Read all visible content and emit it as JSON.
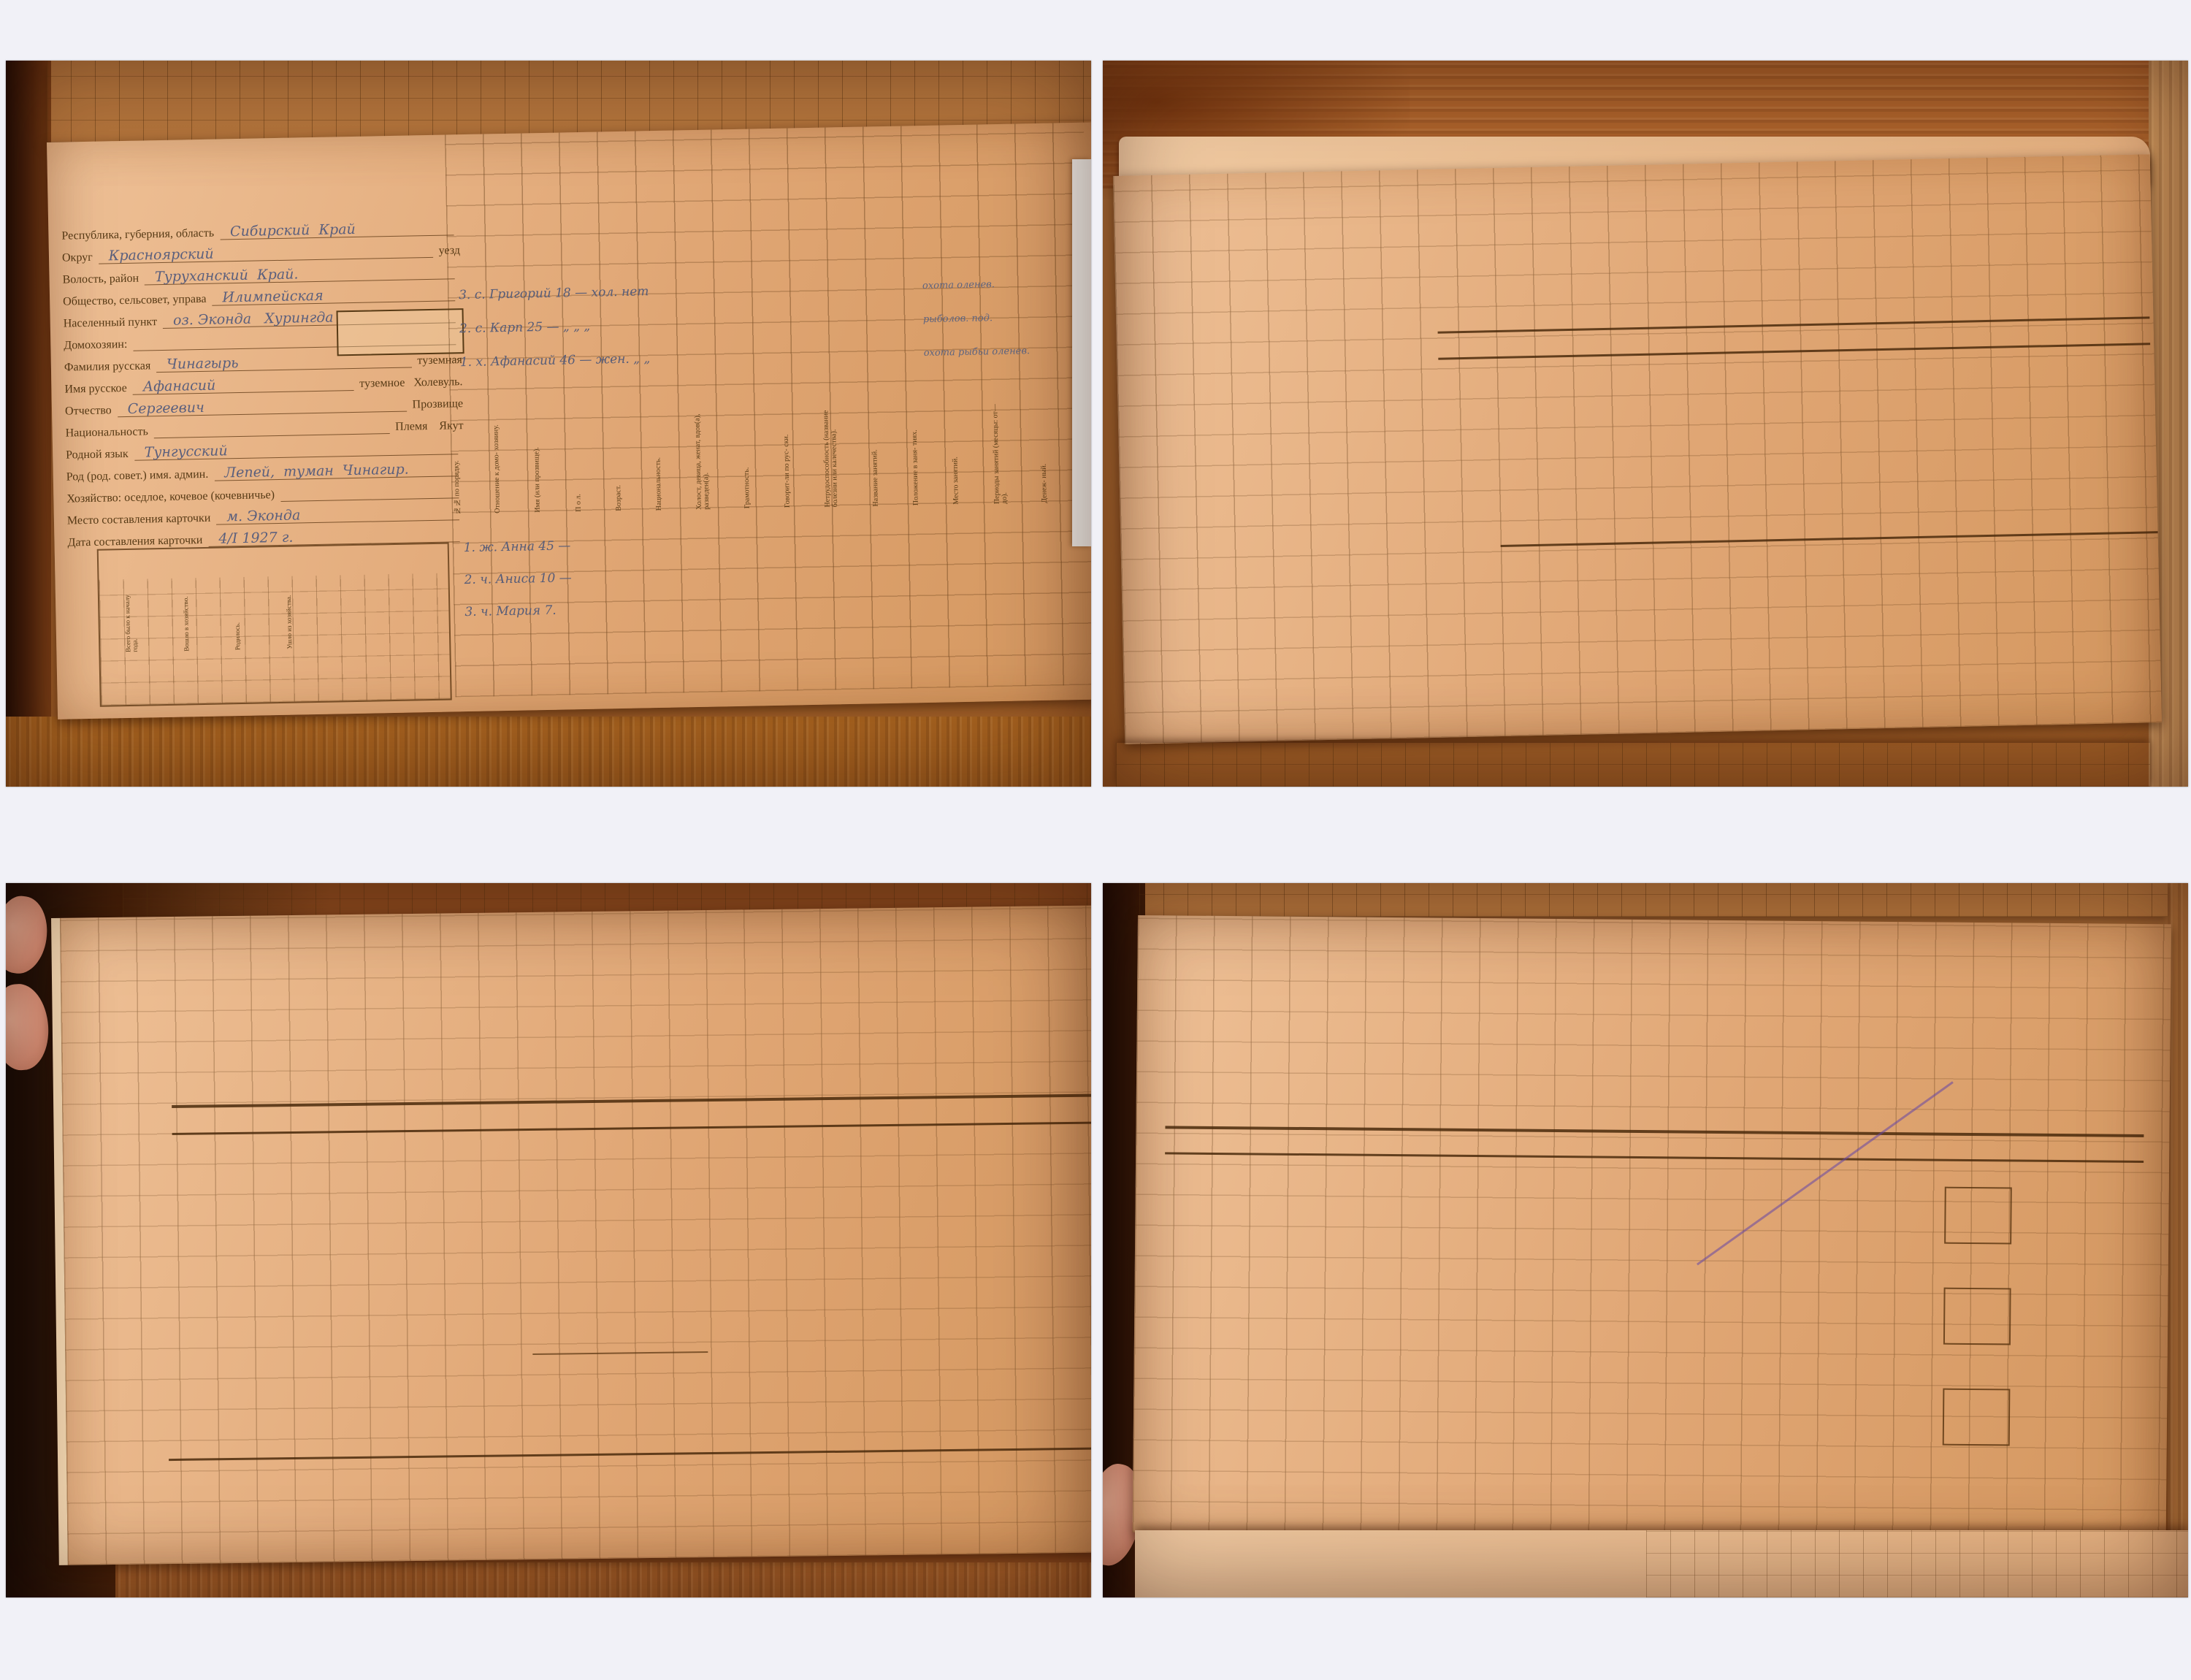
{
  "page": {
    "title": "ГАКК ф.Р769 оп.1 дело 406 21/71"
  },
  "caption": {
    "line1": "23-251,3(РК):007 - оз. Хурунгда - Чинагырь Афанасий Сергеевич [Холевуль]",
    "enumerator": "Enumerator: Наумов Н. П.",
    "date": "1927:01:04",
    "ethnicity": "Якуты",
    "ids": {
      "p1": "GAKK_769-1-406_041",
      "p2": "GAKK_769-1-406_041v",
      "p3": "GAKK_769-1-406_042",
      "p4": "GAKK_769-1-406_042v"
    }
  },
  "p1": {
    "roll": {
      "gosorganam": "Госор- ганам.",
      "vsego": "ВСЕГО.",
      "dobyto": "Добыто за год.",
      "hw": "180  104"
    },
    "ussr": "С.  С.  С.  Р.",
    "csu": "Ц.  С.  У.",
    "census": "Перепись 1926 - 27 года в районах приполярного Севера.",
    "card_title": "ПОХОЗЯЙСТВЕННАЯ  КАРТОЧКА.",
    "fields": [
      {
        "label": "Республика, губерния, область",
        "value": "Сибирский  Край",
        "extra": ""
      },
      {
        "label": "Округ",
        "value": "Красноярский",
        "extra": "уезд"
      },
      {
        "label": "Волость, район",
        "value": "Туруханский  Край.",
        "extra": ""
      },
      {
        "label": "Общество, сельсовет, управа",
        "value": "Илимпейская",
        "extra": ""
      },
      {
        "label": "Населенный пункт",
        "value": "оз. Эконда   Хурингда",
        "extra": ""
      },
      {
        "label": "Домохозяин:",
        "value": "",
        "extra": ""
      },
      {
        "label": "Фамилия русская",
        "value": "Чинагырь",
        "extra": "туземная"
      },
      {
        "label": "Имя русское",
        "value": "Афанасий",
        "extra": "туземное   Холевуль."
      },
      {
        "label": "Отчество",
        "value": "Сергеевич",
        "extra": "Прозвище"
      },
      {
        "label": "Национальность",
        "value": "",
        "extra": "Племя    Якут"
      },
      {
        "label": "Родной язык",
        "value": "Тунгусский",
        "extra": ""
      },
      {
        "label": "Род (род. совет.) имя. админ.",
        "value": "Лепей,  туман  Чинагир.",
        "extra": ""
      },
      {
        "label": "Хозяйство: оседлое, кочевое (кочевничье)",
        "value": "",
        "extra": ""
      },
      {
        "label": "Место составления карточки",
        "value": "м. Эконда",
        "extra": ""
      },
      {
        "label": "Дата составления карточки",
        "value": "4/I 1927 г.",
        "extra": ""
      }
    ],
    "num_box": {
      "no": "№",
      "struck": "13.",
      "value": "7.",
      "list": "по списку домохозяев."
    },
    "movement": {
      "title": "Движение населения в хозяйстве.",
      "cols": [
        "Всего было к началу года.",
        "Вошло в хозяйство.",
        "Родилось.",
        "Ушло из хозяйства."
      ],
      "died": "У М Е Р Л О.",
      "men": "Мужчин.",
      "women": "Женщин.",
      "years": "Годы.",
      "numbers": "40   41   42   43   44   45   46   47   48   49   50   51   52",
      "hw": "3     3",
      "hw2": "3     3"
    },
    "red_mark": "И 23",
    "table": {
      "itogo": "Итого.",
      "hw_itogo": "3.",
      "hw_top": "3",
      "members": [
        "3.    с.    Григорий    18     —    хол.   нет",
        "2.    с.    Карп         25     —    „      „      „",
        "1.    х.    Афанасий   46     —    жен.   „      „"
      ],
      "occupations": [
        "охота  оленев.",
        "рыболов.   под.",
        "охота  рыбьи  оленев."
      ],
      "numbers1": "1    2    3    4   5   6    7   8   9    10    11    12    13    14    15   16   17   18   19   20",
      "headers": [
        "№№ по порядку.",
        "Отношение к домо- хозяину.",
        "Имя (или прозвище).",
        "П о л.",
        "Возраст.",
        "Национальность.",
        "Холост, девица, женат, вдов(а), разведен(а).",
        "Грамотность.",
        "Говорит-ли по рус- ски.",
        "Нетрудоспособность (название болезни или калечества).",
        "Название занятий.",
        "Положение в заня- тиях.",
        "Место занятий.",
        "Периоды занятий (месяцы: от—до).",
        "Денеж- ный.",
        "Натурой (в переводе на деньги)."
      ],
      "numbers2": "21    22    23    24   25   26    27   28   29    30    31    32    33    34    35   36   37   38   39",
      "members_f": [
        "1.    ж.    Анна      45    —",
        "2.    ч.    Аниса    10    —",
        "3.    ч.    Мария    7."
      ]
    },
    "bookmark": "муравьиные яйца, АВГ"
  },
  "p2": {
    "head_cells": [
      "В наличии своего.",
      "Отдано своего на выпас на сторону.",
      "Принято чужого на выпас."
    ],
    "categories": "КАТЕГОРИИ СКОТА.",
    "numbers1": "53  54  55  56  57  58  59  60  61  62  63  64  65  66  67  68  69  70  71  72  73  74  75  76  77  78",
    "cat_labels": [
      "Старше 4 лет.",
      "До 4 лет.",
      "Рабочие.",
      "Гулевые старше 4 лет.",
      "От 1 г. до раб. возраста.",
      "Жеребята до 1 года.",
      "Итого голов.",
      "Волы.",
      "Рабочие.",
      "Производит.",
      "Коровы.",
      "Бычки от 1 до 2 лет.",
      "Нетели и телята.",
      "От 6 мес. до 1 года.",
      "До 6 мес.",
      "Итого голов.",
      "Взрослые.",
      "Ягнята.",
      "Итого голов."
    ],
    "groups": {
      "horses": "Л О Ш А Д И.",
      "cattle": "КРУПНЫЙ  РОГАТЫЙ  СКОТ.",
      "sheep": "О В Ц Ы.",
      "goats": "К О З Ы.",
      "pigs": "СВИНЬИ.",
      "total": "ВСЕГО голов скота."
    },
    "band": "С К О Т ,     К Р О М Е     О Л Е Н Е Й",
    "band_sub": "(число голов).",
    "hire_note": "Наем годовых и сроковых рабочих в течение года.",
    "hire_band": "ПОДЕННЫЙ  И  СДЕЛЬНЫЙ  НАЕМ  РАБОЧИХ.",
    "hire_labels": [
      "Для каких работ нанят (указательно).",
      "Национальность.",
      "Из какого рода.",
      "П о л.",
      "Возраст.",
      "Грамотность.",
      "Местный или пришлый.",
      "Срок найма.",
      "Деньгами.",
      "Натурой в пе- рев. на деньги.",
      "Чья харчи.",
      "Отрасли хозяй- ства, в которых производится работа по найму.",
      "Взросл. рабоч. Муж- чин.",
      "Жен- щин.",
      "Деньгами.",
      "Натурой (в пе- реводе на день- ги)."
    ],
    "numbers2": "111  112  113  114  115 116 117 118 119 120      121      122   123   124   125   126   127      128    129    130    131    132",
    "rows": [
      "Оленеводство.",
      "Рыболовство."
    ],
    "right_rows": [
      "Рыболовство.",
      "Охота  .  .  .",
      "И т о г о.  ."
    ],
    "guns": {
      "vband": "Огнестрельные.",
      "band": "Р У Ж Ь Я.",
      "rows": [
        "Одно- ствол.",
        "Дву- ствол.",
        "Одно- ствол.",
        "Дву- ствол.",
        "Кремне- вые."
      ],
      "extra": [
        "Пистолеты и револьверы.",
        "Луки."
      ]
    },
    "left_numbers": "133 134 135 136 137 138 139 140 141 142 143 144 145",
    "deer": {
      "band": "О Л Е Н И",
      "band_sub": "(число голов по дню переписи).",
      "categories": "КАТЕГОРИИ ОЛЕНЕЙ.",
      "adults": "Взрослые (старше двух лет).",
      "young": "Молодняк",
      "total": "ВСЕГО оленей",
      "cols": [
        "Ездовые",
        "Гулевые.",
        "В С Е Г О.",
        "Из них:"
      ],
      "numbers": "79   80   81   82   83   84   85   86   87   88   89   90  91   92",
      "stock_rows": [
        "Пропало чужих на выпас",
        "Отдано свои на высыл. пост-роят",
        "В наличии своих."
      ],
      "hw": "3   —       3    2   —   1        2   1   —   6"
    },
    "traps": {
      "vband": "Л О В У Ш К И",
      "rows": [
        "Капканы.",
        "Чирканы.",
        "Пасти.",
        "Плашки.",
        "Слопцы.",
        "Петли.",
        "Самострелы."
      ],
      "hw": [
        "1.",
        "10",
        "20",
        "3.",
        "—",
        "—",
        "2."
      ]
    },
    "gear": {
      "title": "СЕТЕВЫЕ СНАСТИ.",
      "rows": [
        "Невода.",
        "Сети.",
        "Пущальни."
      ],
      "hw": "7",
      "units": [
        "Кл. саж.",
        "Штук."
      ],
      "rows2": [
        "Яруса.",
        "Перемёты.",
        "Самоловы."
      ]
    },
    "bird": "Птицеловный инвентарь (число штук).",
    "bottom": {
      "dobyto": "Добыто за год.",
      "vsego": "В с е г о.",
      "hw1": "220        10 15",
      "hw2": "220        10 7"
    },
    "hw_total": "1408,50"
  },
  "p3": {
    "roll": {
      "samostrel": "Самострелы.",
      "hw": "2",
      "numbers": "93  94  95  96  97  98  99  100  101  102  103  104"
    },
    "fur_animals": [
      "Белый медв.",
      "Барсук.",
      "Белка.",
      "Бурундук.",
      "Волк.",
      "Выдра.",
      "Горностай.",
      "Заяц.",
      "Колонок.",
      "Куница.",
      "Лисица.",
      "Медведь бурый.",
      "Песец.",
      "Россомаха.",
      "Рысь.",
      "Соболь.",
      "Хорек.",
      "Тарбаган.",
      "Кабарга.",
      "Дикая коза.",
      "Олень дикий.",
      "Лось.",
      "Изюбры."
    ],
    "band1": "П Р О Д У К Ц И Я    П У Ш Н О Г О    П Р О М Ы С Л А",
    "band1_sub": "(в штуках).",
    "band2": "П О С Т Р О Й К И.",
    "permanent": "П О С Т О Я Н Н Ы Е.",
    "portable": "ПЕРЕНОСНЫЕ.",
    "note_title": "П р и м е ч а н и е.",
    "note_lines": [
      "20 белок продано А. Я. Узенгир",
      "10 горностаев дано за оленей",
      "Ясейским Якутам, приезжав-",
      "шим сюда.",
      "Несколько песцов дымчатого роз-",
      "дано бесплатно сиротам."
    ],
    "groups": [
      "Жилые.",
      "Хозяйственные.",
      "Специально про- мысловые."
    ],
    "build_labels": [
      "Рубле- ные.",
      "Досча- тые.",
      "Зимовья.",
      "Только для жилья.",
      "Для жилья и скота.",
      "Амбары.",
      "Сараи.",
      "Избушки.",
      "Лабазы.",
      "Чумы (юрты зимние).",
      "Чумы (юрты летние)."
    ],
    "numbers1": "217  218  219  220  221  222  223  224  225  226  227  228  229  230     231     232     233     234",
    "hw_counts": [
      "3",
      "3",
      "1."
    ],
    "land": {
      "title": "Землепользование (десятин ).",
      "cols": [
        "Усадьбы.",
        "Покос.",
        "Итого."
      ],
      "numbers": "235    236    237         238"
    },
    "signature": "Регистратор   АНаумов",
    "left_rows": [
      "Баркасы.",
      "Крытые (илимки).",
      "Открытые.",
      "Обласки.",
      "Долбленки.",
      "Берестяные.",
      "По полоз- ном ходу.",
      "На деревян- ном ходу.",
      "Двуколки.",
      "Сани русские.",
      "Полки.",
      "Грузовые.",
      "Легковые."
    ],
    "left_vband": "Водотранспортный инвентарь и рыболовные суда (число штук).",
    "margin_marks": [
      "1.",
      "3",
      "5",
      "6"
    ],
    "hw_top_right": "280 —",
    "bottom_bands": [
      "Продукция морского зверобойного промысла.",
      "Продукция птицеводства (в штуках).",
      "Продукция прочих добывающих промыслов."
    ],
    "bottom_labels": [
      "Белу- хи.",
      "Шкур.",
      "Сала (пуд.).",
      "Нер- пы.",
      "Глухари.",
      "Тетерева.",
      "Рябчики.",
      "Куропатки.",
      "Утки.",
      "Гуси.",
      "Турпаны.",
      "Кедр. орех (пуд.).",
      "Ягоды (пуд.)."
    ],
    "numbers2": "284  285  286  287  288  289  290  291  292  293  294  295  296  297  298",
    "hw_big": {
      "a": "10   30 1/2",
      "b": "50",
      "c": "30 е",
      "d": "60 р 50 к",
      "e": "5-11-  30 1/8",
      "f": "96"
    }
  },
  "p4": {
    "deerprod": {
      "title": "Продукция оленеводст. а.",
      "shkur": "Шкур.",
      "numbers": "350  351  352  353  354",
      "hw1": "Посная",
      "hw2": "Камус."
    },
    "fish_band": "П Р О Д У К Ц И Я     Р Ы Б О Л О В С Т В А",
    "fish_band_sub": "(в пудах).",
    "vband": "П Р О М Ы С Л Ы",
    "trade_title": "Торгово-промышленные заведения.",
    "trade_count": "Число заведений.",
    "trade_name": "НАЗВАНИЕ ЗАВЕ- ДЕНИЯ.",
    "trade_cols": [
      "Всех.",
      "С наемными рабочими."
    ],
    "trade_numbers": "371            372       373",
    "credit_band": "К  Р  Е  Д  И  Т.",
    "credit_hw": "Погашено  долга  в 1925-26 г. —",
    "debt": "ЗАДОЛЖЕННОСТЬ.",
    "money": "День- гами (сум- ма).",
    "natural": "НАТУРОЙ (что и сколько).",
    "terms": "Условия кре- дита.",
    "term_cols": [
      "Срок.",
      "Размер про- центов."
    ],
    "loan_label": "Взято в долг в тече- ние 1925—26 года.",
    "credit_rows": [
      "Госорганы.",
      "Кооперации.",
      "Частным лицам.",
      "И т о г о."
    ],
    "credit_last": "В течение 1925— 26 года дано в долг.",
    "credit_numbers": "379   378   377   376   375   374",
    "credit_hw2": [
      {
        "n": "120-",
        "t": "Золеня"
      },
      {
        "n": "120-",
        "t": "Золеня"
      }
    ],
    "cells_title": "Клетки для разметок при разработке",
    "rom1": [
      {
        "r": "I",
        "h": "Сл"
      },
      {
        "r": "II",
        "h": "М"
      },
      {
        "r": "III",
        "h": "Бс"
      }
    ],
    "rom2": [
      {
        "r": "IV",
        "h": "рб"
      },
      {
        "r": "V",
        "h": "кр"
      },
      {
        "r": "VI",
        "h": "вс"
      }
    ],
    "rom3": [
      {
        "r": "VII",
        "h": ""
      },
      {
        "r": "VIII",
        "h": ""
      },
      {
        "r": "IX",
        "h": ""
      }
    ],
    "big_hw": {
      "a": "—",
      "b": "12",
      "c": "1469—",
      "d": "600",
      "e": "0/30",
      "f": "2111—",
      "g": "6",
      "h": "Ейя",
      "i": "Юле",
      "n21": "21"
    },
    "hay": {
      "title": "СБОР СЕНА (в пудах).",
      "rows": [
        "Заливного.",
        "Лугового, су- ходольного.",
        "Болотного.",
        "Лесного.",
        "И т о г о."
      ],
      "numbers": "364 365 366 367 368 369 370"
    },
    "years": [
      "в 1925 году",
      "в 1926 году"
    ],
    "purchase": {
      "pre_hw": "120-83",
      "band": "П О К У П К А     Т О В А Р О В",
      "sub": "(за год куплено).",
      "post_hw": "34-57"
    },
    "goods_groups": [
      "Чай.",
      "Табак."
    ],
    "goods": [
      "Мука ржаная.",
      "Мука пшенич- ная.",
      "Сушки, ба- ранки, сухари.",
      "Масло коровье.",
      "Байховый.",
      "Кирпичный.",
      "Сахар.",
      "Нюхатель- ный.",
      "Листовой.",
      "Махорка.",
      "Водка.",
      "Спирт.",
      "Соль.",
      "Керосин.",
      "Ситец.",
      "Порох.",
      "Дробь (сви- нец).",
      "Стрихнин.",
      "Ружья.",
      "Прядево для сетей."
    ],
    "goods_numbers": "380 381 382 383 384 385 386 387 388 389 390 391 392 393 394 395 396 397 398 399 400 401",
    "units_label": "Единица измерен.",
    "units_hw": "пуд  —   ф  —   ш ф   —   об  —   —   ф  —  шф",
    "hw_row": "4   19. —     10   —    7. 15       8.   —        30. —    9.  14",
    "vsego": "ВСЕГО.",
    "dobyto": "Добыто за год.",
    "dobyto_hw": "200   2   —    2   —",
    "green_hw": "У00  2  1",
    "red_hw": "19118",
    "next_card": {
      "ussr": "С.  С.  С.  Р.",
      "csu": "Ц.  С.  У.",
      "census": "Перепись 1926   27 года в районах приполярного Севера.",
      "title": "ПОХОЗЯЙСТВЕННАЯ  КАРТОЧКА.",
      "itogo": "Итого.",
      "hw1": "2",
      "hw2": "2"
    }
  }
}
